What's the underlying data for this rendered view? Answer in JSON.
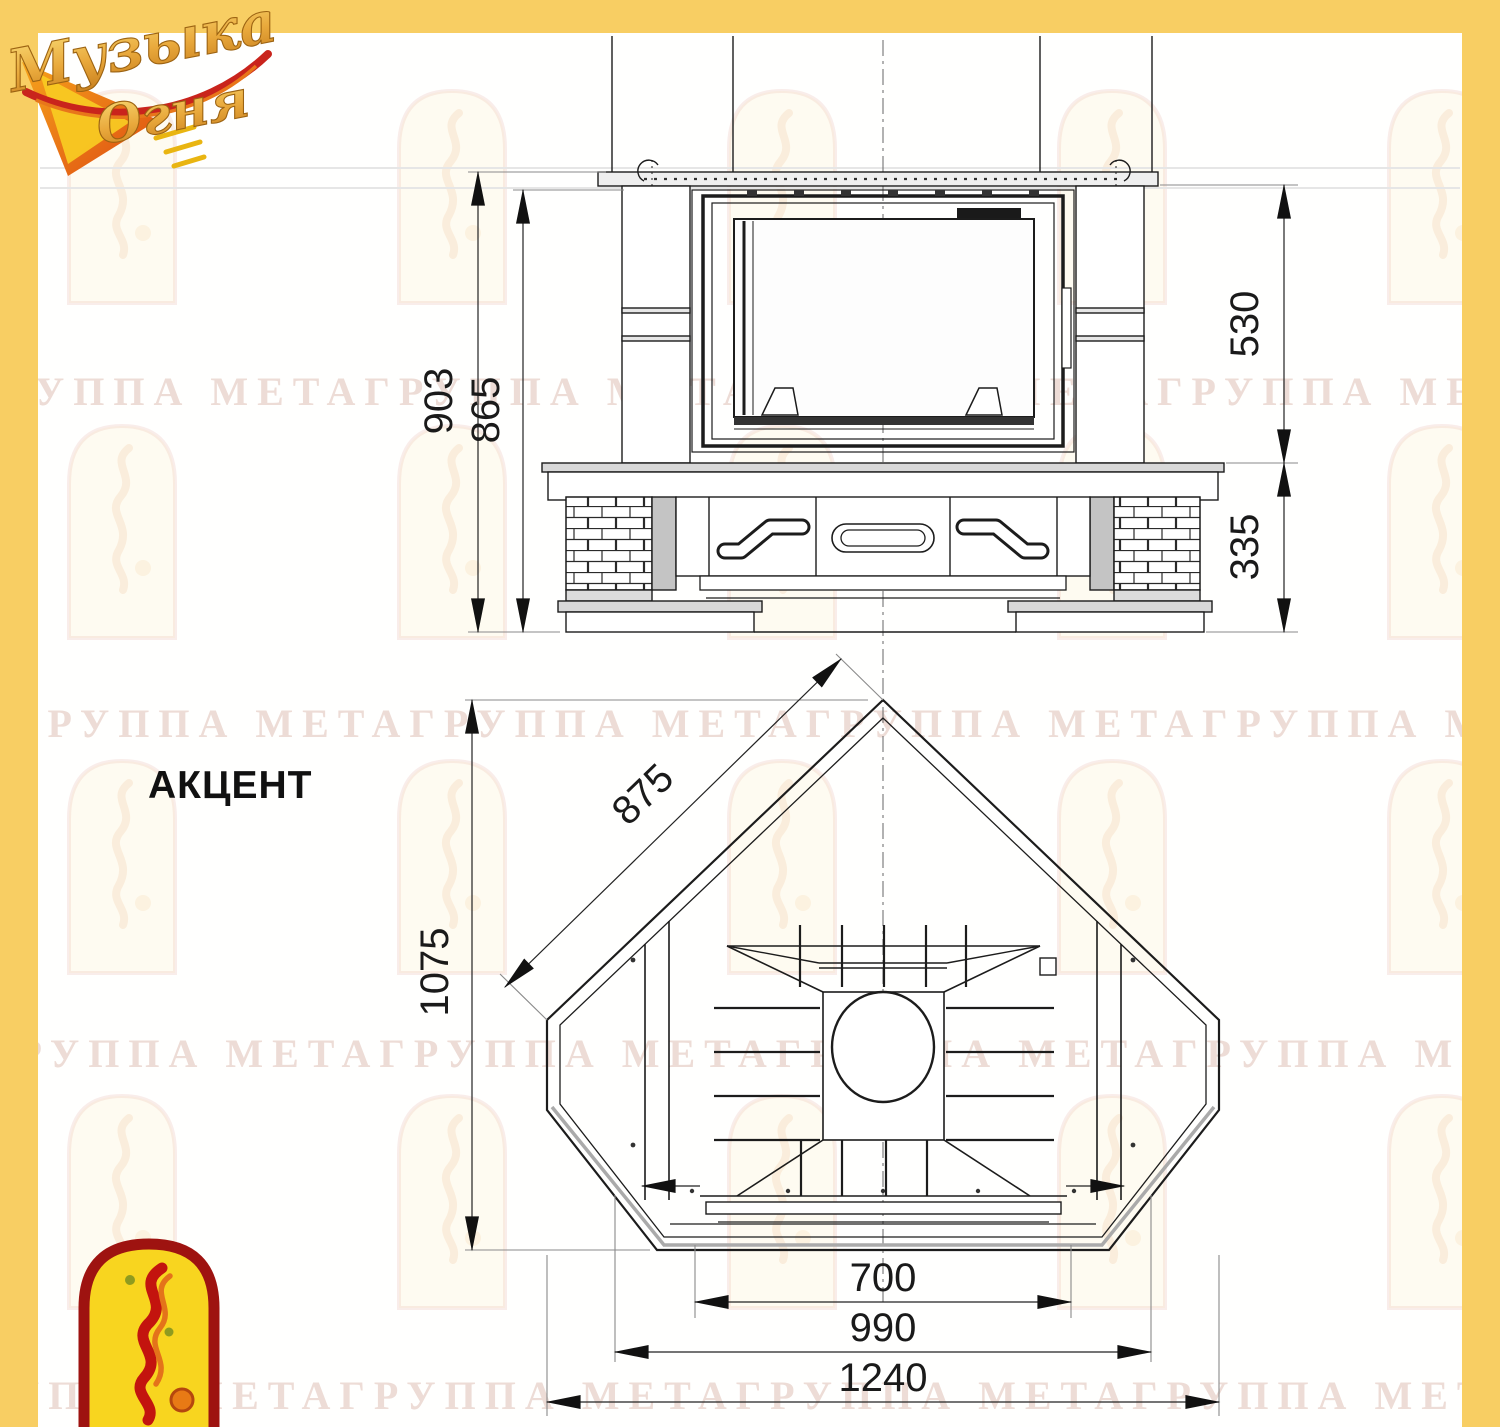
{
  "title": {
    "model_name": "АКЦЕНТ"
  },
  "brand_logo": {
    "word1": "Музыка",
    "word2": "Огня"
  },
  "watermark": {
    "text": "ГРУППА МЕТАГРУППА МЕТАГРУППА МЕТАГРУППА МЕТАГРУППА МЕТА"
  },
  "front_view": {
    "height_total": "903",
    "height_below_mantel": "865",
    "insert_height": "530",
    "base_height": "335"
  },
  "plan_view": {
    "side_face_width": "875",
    "depth": "1075",
    "opening_width": "700",
    "inner_width": "990",
    "overall_width": "1240"
  },
  "colors": {
    "frame_yellow": "#F8CE63",
    "canvas_white": "#FFFFFE",
    "line_dark": "#1c1c1c",
    "emblem_red": "#9E1310",
    "emblem_yellow": "#F8D51F"
  }
}
